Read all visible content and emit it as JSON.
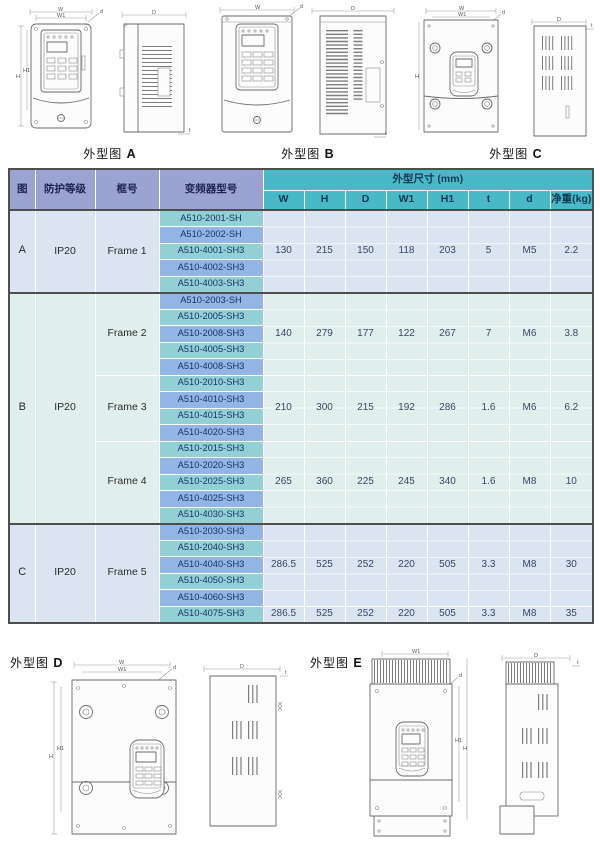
{
  "figure_labels": {
    "prefix": "外型图",
    "top": [
      "A",
      "B",
      "C"
    ],
    "bottom": [
      "D",
      "E"
    ]
  },
  "dims": {
    "w": "W",
    "w1": "W1",
    "h": "H",
    "h1": "H1",
    "d": "D",
    "d_screw": "d",
    "t": "t"
  },
  "colors": {
    "header_lavender": "#9ba3d3",
    "header_teal": "#49b9c7",
    "model_teal": "#92d0d6",
    "model_blue": "#92b5e3",
    "group_blue_bg": "#dbe5f1",
    "group_cyan_bg": "#e1efec"
  },
  "table": {
    "headers": {
      "fig": "图",
      "protection": "防护等级",
      "frame": "框号",
      "model": "变频器型号",
      "dims_group": "外型尺寸 (mm)",
      "cols": [
        "W",
        "H",
        "D",
        "W1",
        "H1",
        "t",
        "d",
        "净重(kg)"
      ]
    },
    "groups": [
      {
        "fig": "A",
        "protection": "IP20",
        "bg": "bg-blue",
        "frames": [
          {
            "name": "Frame 1",
            "models": [
              "A510-2001-SH",
              "A510-2002-SH",
              "A510-4001-SH3",
              "A510-4002-SH3",
              "A510-4003-SH3"
            ],
            "specs": [
              {
                "rows": 5,
                "values": [
                  "130",
                  "215",
                  "150",
                  "118",
                  "203",
                  "5",
                  "M5",
                  "2.2"
                ]
              }
            ]
          }
        ]
      },
      {
        "fig": "B",
        "protection": "IP20",
        "bg": "bg-cyan",
        "frames": [
          {
            "name": "Frame 2",
            "models": [
              "A510-2003-SH",
              "A510-2005-SH3",
              "A510-2008-SH3",
              "A510-4005-SH3",
              "A510-4008-SH3"
            ],
            "specs": [
              {
                "rows": 5,
                "values": [
                  "140",
                  "279",
                  "177",
                  "122",
                  "267",
                  "7",
                  "M6",
                  "3.8"
                ]
              }
            ]
          },
          {
            "name": "Frame 3",
            "models": [
              "A510-2010-SH3",
              "A510-4010-SH3",
              "A510-4015-SH3",
              "A510-4020-SH3"
            ],
            "specs": [
              {
                "rows": 4,
                "values": [
                  "210",
                  "300",
                  "215",
                  "192",
                  "286",
                  "1.6",
                  "M6",
                  "6.2"
                ]
              }
            ]
          },
          {
            "name": "Frame 4",
            "models": [
              "A510-2015-SH3",
              "A510-2020-SH3",
              "A510-2025-SH3",
              "A510-4025-SH3",
              "A510-4030-SH3"
            ],
            "specs": [
              {
                "rows": 5,
                "values": [
                  "265",
                  "360",
                  "225",
                  "245",
                  "340",
                  "1.6",
                  "M8",
                  "10"
                ]
              }
            ]
          }
        ]
      },
      {
        "fig": "C",
        "protection": "IP20",
        "bg": "bg-blue",
        "frames": [
          {
            "name": "Frame 5",
            "models": [
              "A510-2030-SH3",
              "A510-2040-SH3",
              "A510-4040-SH3",
              "A510-4050-SH3",
              "A510-4060-SH3",
              "A510-4075-SH3"
            ],
            "specs": [
              {
                "rows": 5,
                "values": [
                  "286.5",
                  "525",
                  "252",
                  "220",
                  "505",
                  "3.3",
                  "M8",
                  "30"
                ]
              },
              {
                "rows": 1,
                "values": [
                  "286.5",
                  "525",
                  "252",
                  "220",
                  "505",
                  "3.3",
                  "M8",
                  "35"
                ]
              }
            ]
          }
        ]
      }
    ]
  }
}
